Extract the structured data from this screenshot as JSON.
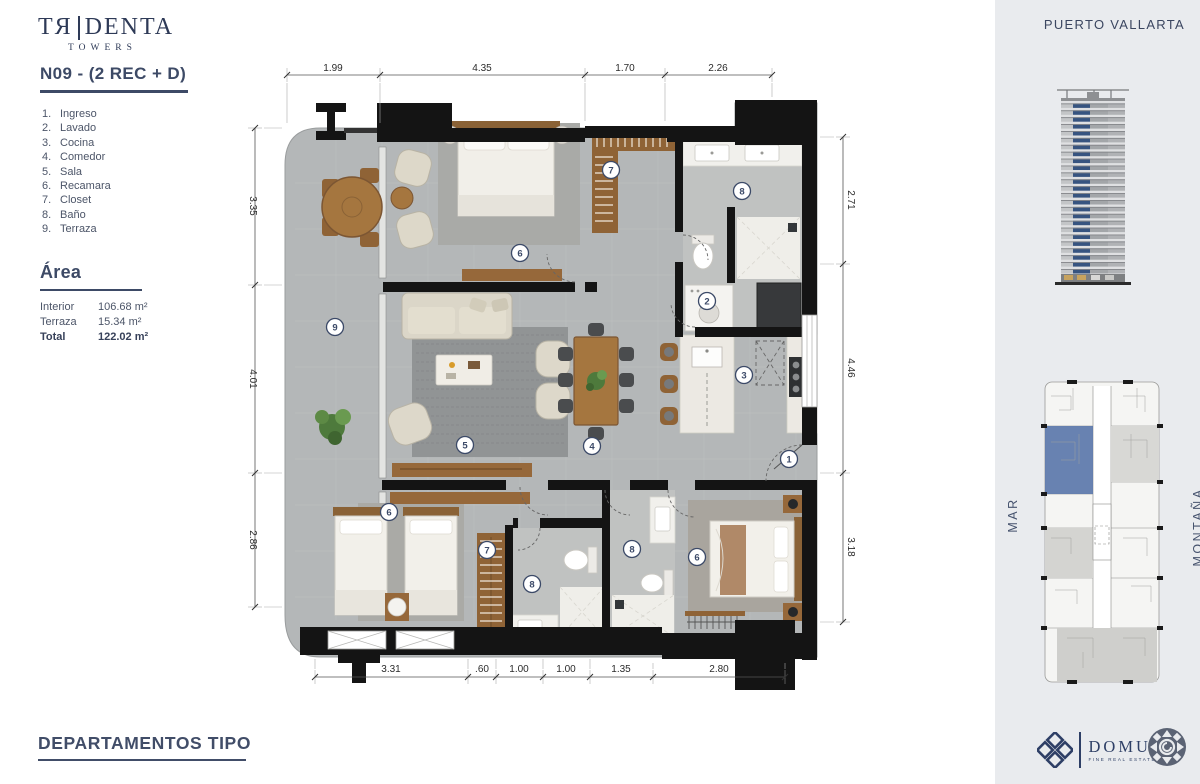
{
  "brand": {
    "left": "TЯ",
    "right": "DENTA",
    "sub": "TOWERS"
  },
  "unit": {
    "title": "N09 - (2 REC + D)"
  },
  "legend": [
    {
      "n": "1.",
      "label": "Ingreso"
    },
    {
      "n": "2.",
      "label": "Lavado"
    },
    {
      "n": "3.",
      "label": "Cocina"
    },
    {
      "n": "4.",
      "label": "Comedor"
    },
    {
      "n": "5.",
      "label": "Sala"
    },
    {
      "n": "6.",
      "label": "Recamara"
    },
    {
      "n": "7.",
      "label": "Closet"
    },
    {
      "n": "8.",
      "label": "Baño"
    },
    {
      "n": "9.",
      "label": "Terraza"
    }
  ],
  "area": {
    "heading": "Área",
    "rows": [
      {
        "label": "Interior",
        "value": "106.68 m²"
      },
      {
        "label": "Terraza",
        "value": "15.34 m²"
      },
      {
        "label": "Total",
        "value": "122.02 m²"
      }
    ]
  },
  "plan": {
    "dims": {
      "top": [
        "1.99",
        "4.35",
        "1.70",
        "2.26"
      ],
      "bottom": [
        "3.31",
        ".60",
        "1.00",
        "1.00",
        "1.35",
        "2.80"
      ],
      "left": [
        "3.35",
        "4.01",
        "2.86"
      ],
      "right": [
        "2.71",
        "4.46",
        "3.18"
      ]
    },
    "markers": [
      "9",
      "6",
      "7",
      "8",
      "2",
      "3",
      "5",
      "4",
      "1",
      "6",
      "7",
      "8",
      "8",
      "6"
    ]
  },
  "sidebar": {
    "location": "PUERTO VALLARTA",
    "mar": "MAR",
    "montana": "MONTAÑA"
  },
  "footer": {
    "section": "DEPARTAMENTOS TIPO",
    "domus_name": "DOMUS",
    "domus_tagline": "FINE REAL ESTATE  ®"
  },
  "colors": {
    "navy": "#3d4a66",
    "sidebar_bg": "#e9ebee",
    "plan_floor": "#b4b7b8",
    "wood": "#a5763f",
    "wall": "#141414",
    "keyplan_highlight": "#5b77ab",
    "tower_blue": "#375480"
  }
}
